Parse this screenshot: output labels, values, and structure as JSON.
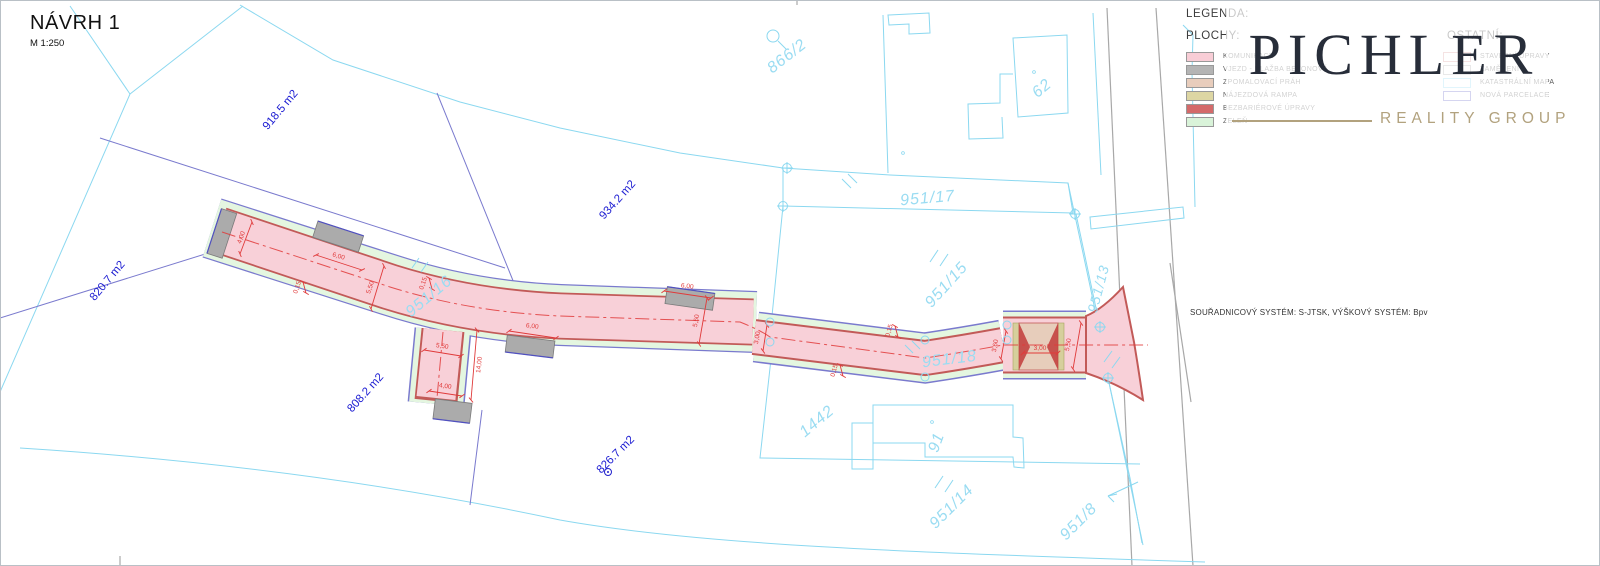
{
  "title": {
    "text": "NÁVRH 1",
    "scale": "M 1:250"
  },
  "legend": {
    "title": "LEGENDA:",
    "plochy": {
      "title": "PLOCHY:",
      "items": [
        {
          "label": "KOMUNIKACE",
          "color": "#f8cdd6"
        },
        {
          "label": "VJEZD - DLAŽBA BETONOVÁ",
          "color": "#b4b4b4"
        },
        {
          "label": "ZPOMALOVACÍ PRÁH",
          "color": "#e8cdbc"
        },
        {
          "label": "NÁJEZDOVÁ RAMPA",
          "color": "#ddd6a3"
        },
        {
          "label": "BEZBARIÉROVÉ ÚPRAVY",
          "color": "#d46a6a"
        },
        {
          "label": "ZELEŇ",
          "color": "#d9f3d9"
        }
      ]
    },
    "ostatni": {
      "title": "OSTATNÍ:",
      "items": [
        {
          "label": "STAVEBNÍ ÚPRAVY",
          "color": "#dc9a9a"
        },
        {
          "label": "ZAMĚŘENÍ",
          "color": "#b0b0b0"
        },
        {
          "label": "KATASTRÁLNÍ MAPA",
          "color": "#93dbf5"
        },
        {
          "label": "NOVÁ PARCELACE",
          "color": "#6a6ac8"
        }
      ]
    }
  },
  "watermark": {
    "brand": "PICHLER",
    "subtitle": "REALITY GROUP"
  },
  "note": "SOUŘADNICOVÝ SYSTÉM: S-JTSK, VÝŠKOVÝ SYSTÉM: Bpv",
  "map": {
    "area_labels": [
      {
        "text": "918.5 m2"
      },
      {
        "text": "820.7 m2"
      },
      {
        "text": "934.2 m2"
      },
      {
        "text": "808.2 m2"
      },
      {
        "text": "826.7 m2"
      }
    ],
    "parcel_labels": [
      {
        "text": "866/2"
      },
      {
        "text": "62"
      },
      {
        "text": "951/17"
      },
      {
        "text": "951/15"
      },
      {
        "text": "951/16"
      },
      {
        "text": "951/18"
      },
      {
        "text": "951/13"
      },
      {
        "text": "1442"
      },
      {
        "text": "91"
      },
      {
        "text": "951/14"
      },
      {
        "text": "951/8"
      }
    ],
    "dimensions": [
      {
        "text": "4,00"
      },
      {
        "text": "6,00"
      },
      {
        "text": "0,15"
      },
      {
        "text": "5,50"
      },
      {
        "text": "0,15"
      },
      {
        "text": "5,50"
      },
      {
        "text": "4,00"
      },
      {
        "text": "14,00"
      },
      {
        "text": "6,00"
      },
      {
        "text": "6,00"
      },
      {
        "text": "5,50"
      },
      {
        "text": "0,15"
      },
      {
        "text": "0,15"
      },
      {
        "text": "3,00"
      },
      {
        "text": "3,60"
      },
      {
        "text": "3,00"
      },
      {
        "text": "5,50"
      }
    ]
  },
  "colors": {
    "pink": "#f8d0d8",
    "pinkEdge": "#c25a58",
    "green": "#e4f6e0",
    "indigo": "#7a7ace",
    "cyan": "#8bd8f0",
    "cyanText": "#9adcf2",
    "blueText": "#1c1cd2",
    "red": "#e03a3a",
    "gray": "#ababab",
    "grayRoad": "#a8a8a8",
    "tan": "#e7cdbb",
    "olive": "#d6cf9c",
    "wedge": "#c34441",
    "blueLine": "#5050c0"
  }
}
